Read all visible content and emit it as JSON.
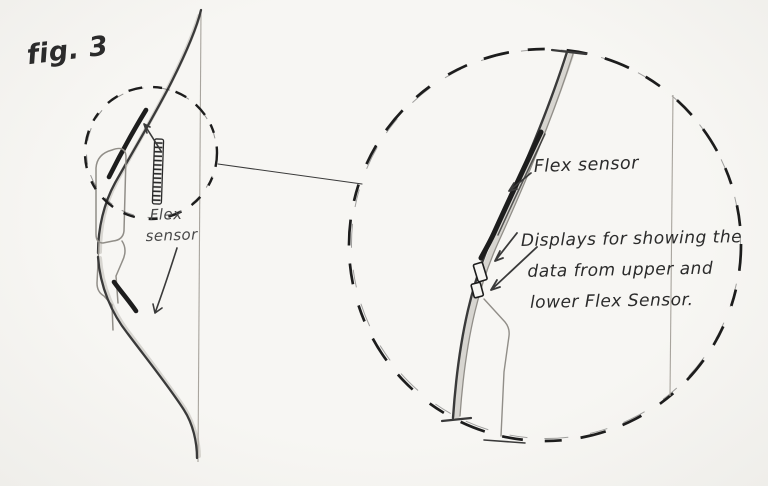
{
  "labels": {
    "figure": "fig. 3",
    "overview_flex_line1": "Flex",
    "overview_flex_line2": "sensor",
    "detail_flex": "Flex sensor",
    "detail_displays_line1": "Displays for showing the",
    "detail_displays_line2": "data from upper and",
    "detail_displays_line3": "lower Flex Sensor."
  },
  "colors": {
    "paper": "#f5f4f0",
    "pencil": "#3a3a3a",
    "pencil-dark": "#1d1d1d",
    "pencil-light": "#918e88",
    "string": "#a8a49d",
    "ink": "#2b2b2b",
    "shade": "#bdbab3"
  }
}
